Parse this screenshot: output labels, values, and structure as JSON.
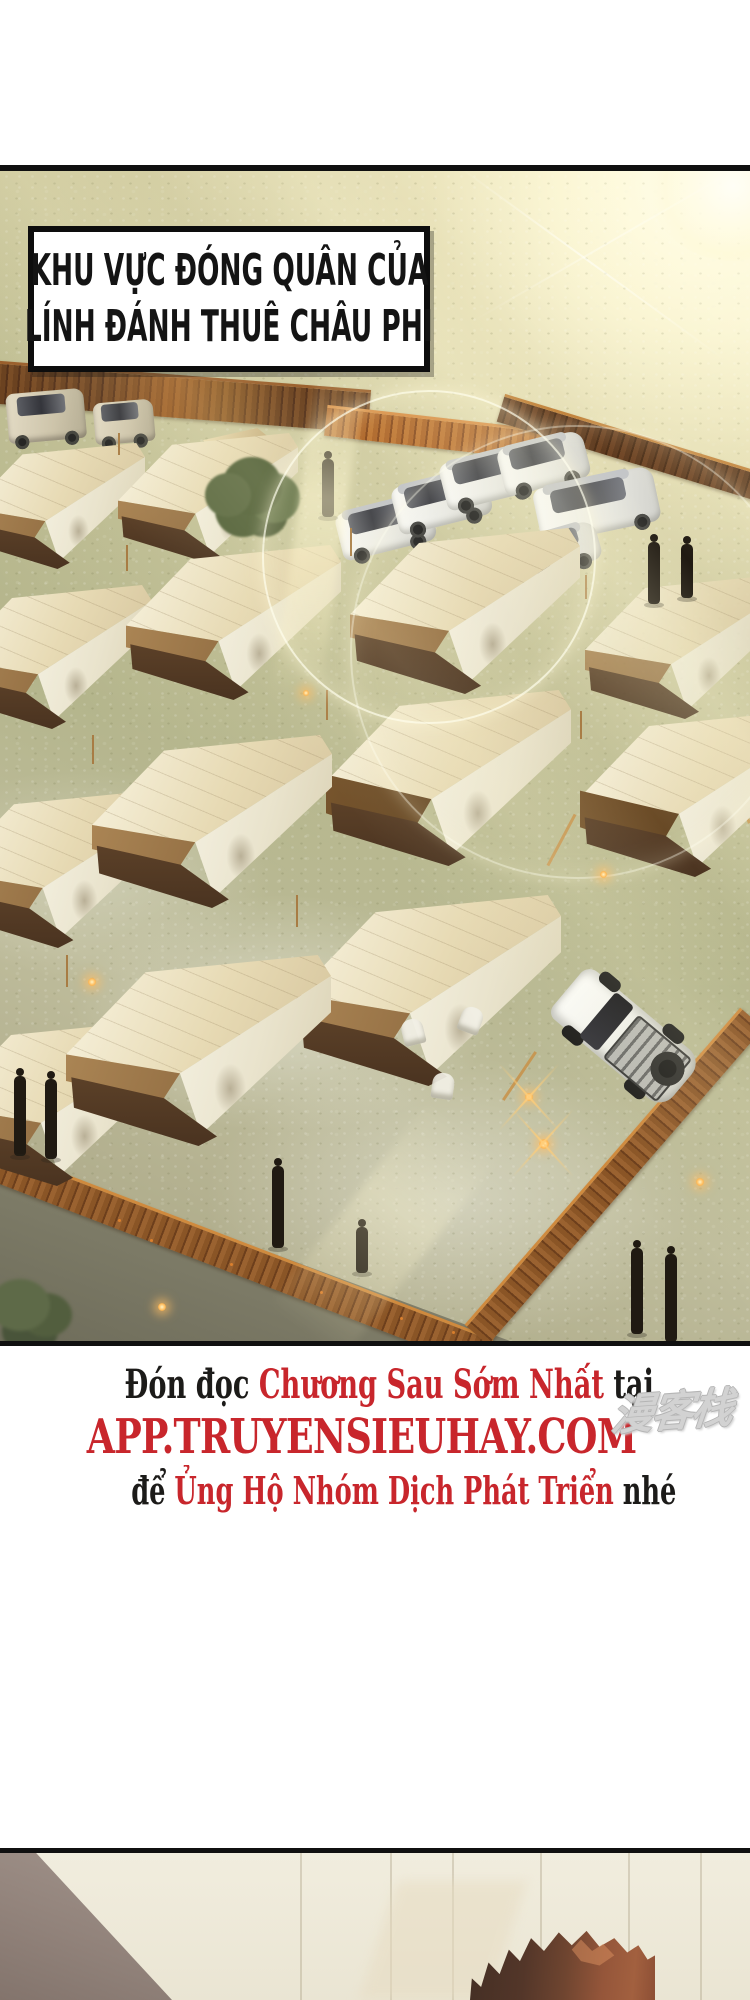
{
  "panel_caption": {
    "line1": "KHU VỰC ĐÓNG QUÂN CỦA",
    "line2": "LÍNH ĐÁNH THUÊ CHÂU PHI"
  },
  "promo": {
    "lines": [
      {
        "size": "sm",
        "segments": [
          {
            "text": "Đón đọc ",
            "color": "#1c1b19"
          },
          {
            "text": "Chương Sau Sớm Nhất",
            "color": "#c8262c"
          },
          {
            "text": " tại",
            "color": "#1c1b19"
          }
        ]
      },
      {
        "size": "lg",
        "segments": [
          {
            "text": "APP.TRUYENSIEUHAY.COM",
            "color": "#c8262c"
          }
        ]
      },
      {
        "size": "sm2",
        "segments": [
          {
            "text": "để ",
            "color": "#1c1b19"
          },
          {
            "text": "Ủng Hộ Nhóm Dịch Phát Triển",
            "color": "#c8262c"
          },
          {
            "text": " nhé",
            "color": "#1c1b19"
          }
        ]
      }
    ]
  },
  "watermark": {
    "text": "漫客栈",
    "color": "#d2d2d2"
  },
  "colors": {
    "promo_red": "#c8262c",
    "text_black": "#1c1b19",
    "panel_border": "#101010"
  }
}
